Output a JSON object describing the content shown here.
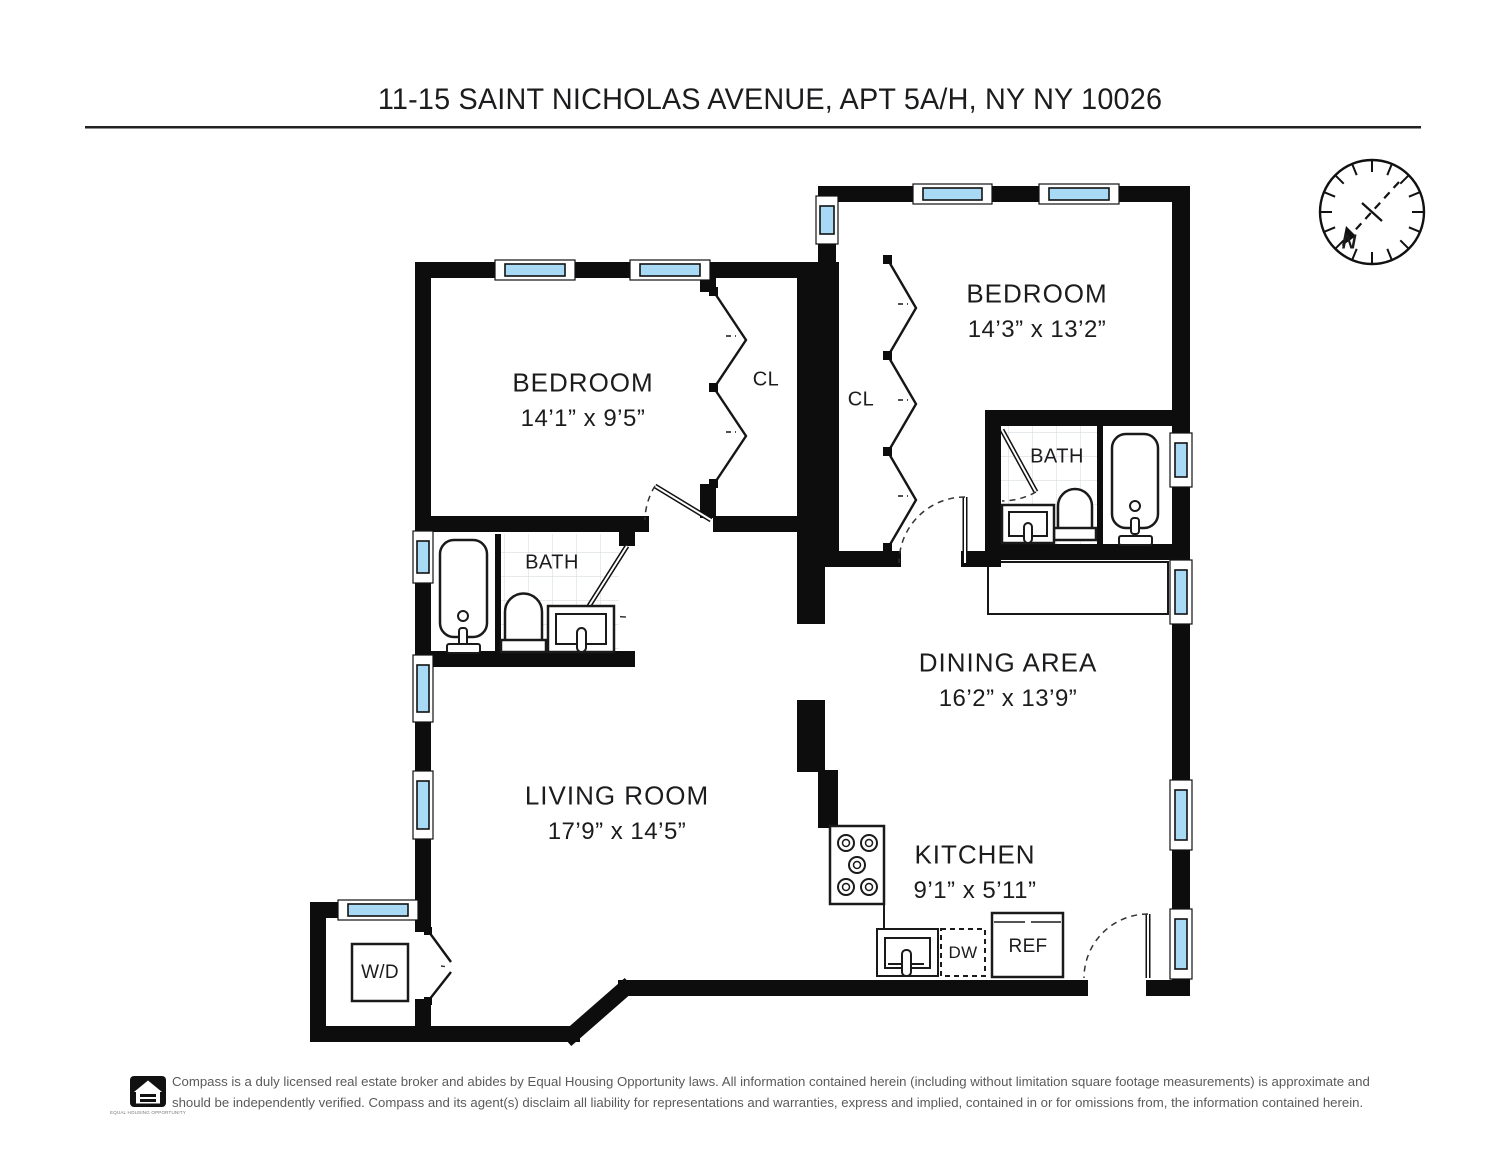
{
  "title": "11-15 SAINT NICHOLAS AVENUE, APT 5A/H, NY NY 10026",
  "compass": {
    "north_label": "N"
  },
  "rooms": {
    "bedroom_right": {
      "name": "BEDROOM",
      "dimensions": "14’3” x 13’2”"
    },
    "bedroom_left": {
      "name": "BEDROOM",
      "dimensions": "14’1” x 9’5”"
    },
    "dining": {
      "name": "DINING AREA",
      "dimensions": "16’2” x 13’9”"
    },
    "living": {
      "name": "LIVING ROOM",
      "dimensions": "17’9” x 14’5”"
    },
    "kitchen": {
      "name": "KITCHEN",
      "dimensions": "9’1” x 5’11”"
    },
    "bath_right": {
      "name": "BATH"
    },
    "bath_left": {
      "name": "BATH"
    },
    "closet_left": {
      "name": "CL"
    },
    "closet_middle": {
      "name": "CL"
    }
  },
  "appliances": {
    "washer_dryer": "W/D",
    "dishwasher": "DW",
    "refrigerator": "REF"
  },
  "footer": {
    "eho_label": "EQUAL HOUSING OPPORTUNITY",
    "line1": "Compass is a duly licensed real estate broker and abides by Equal Housing Opportunity laws. All information contained herein (including without limitation square footage measurements) is approximate and",
    "line2": "should be independently verified. Compass and its agent(s) disclaim all liability for representations and warranties, express and implied, contained in or for omissions from, the information contained herein."
  },
  "colors": {
    "wall": "#0d0d0d",
    "window_glass": "#a8daf5"
  }
}
